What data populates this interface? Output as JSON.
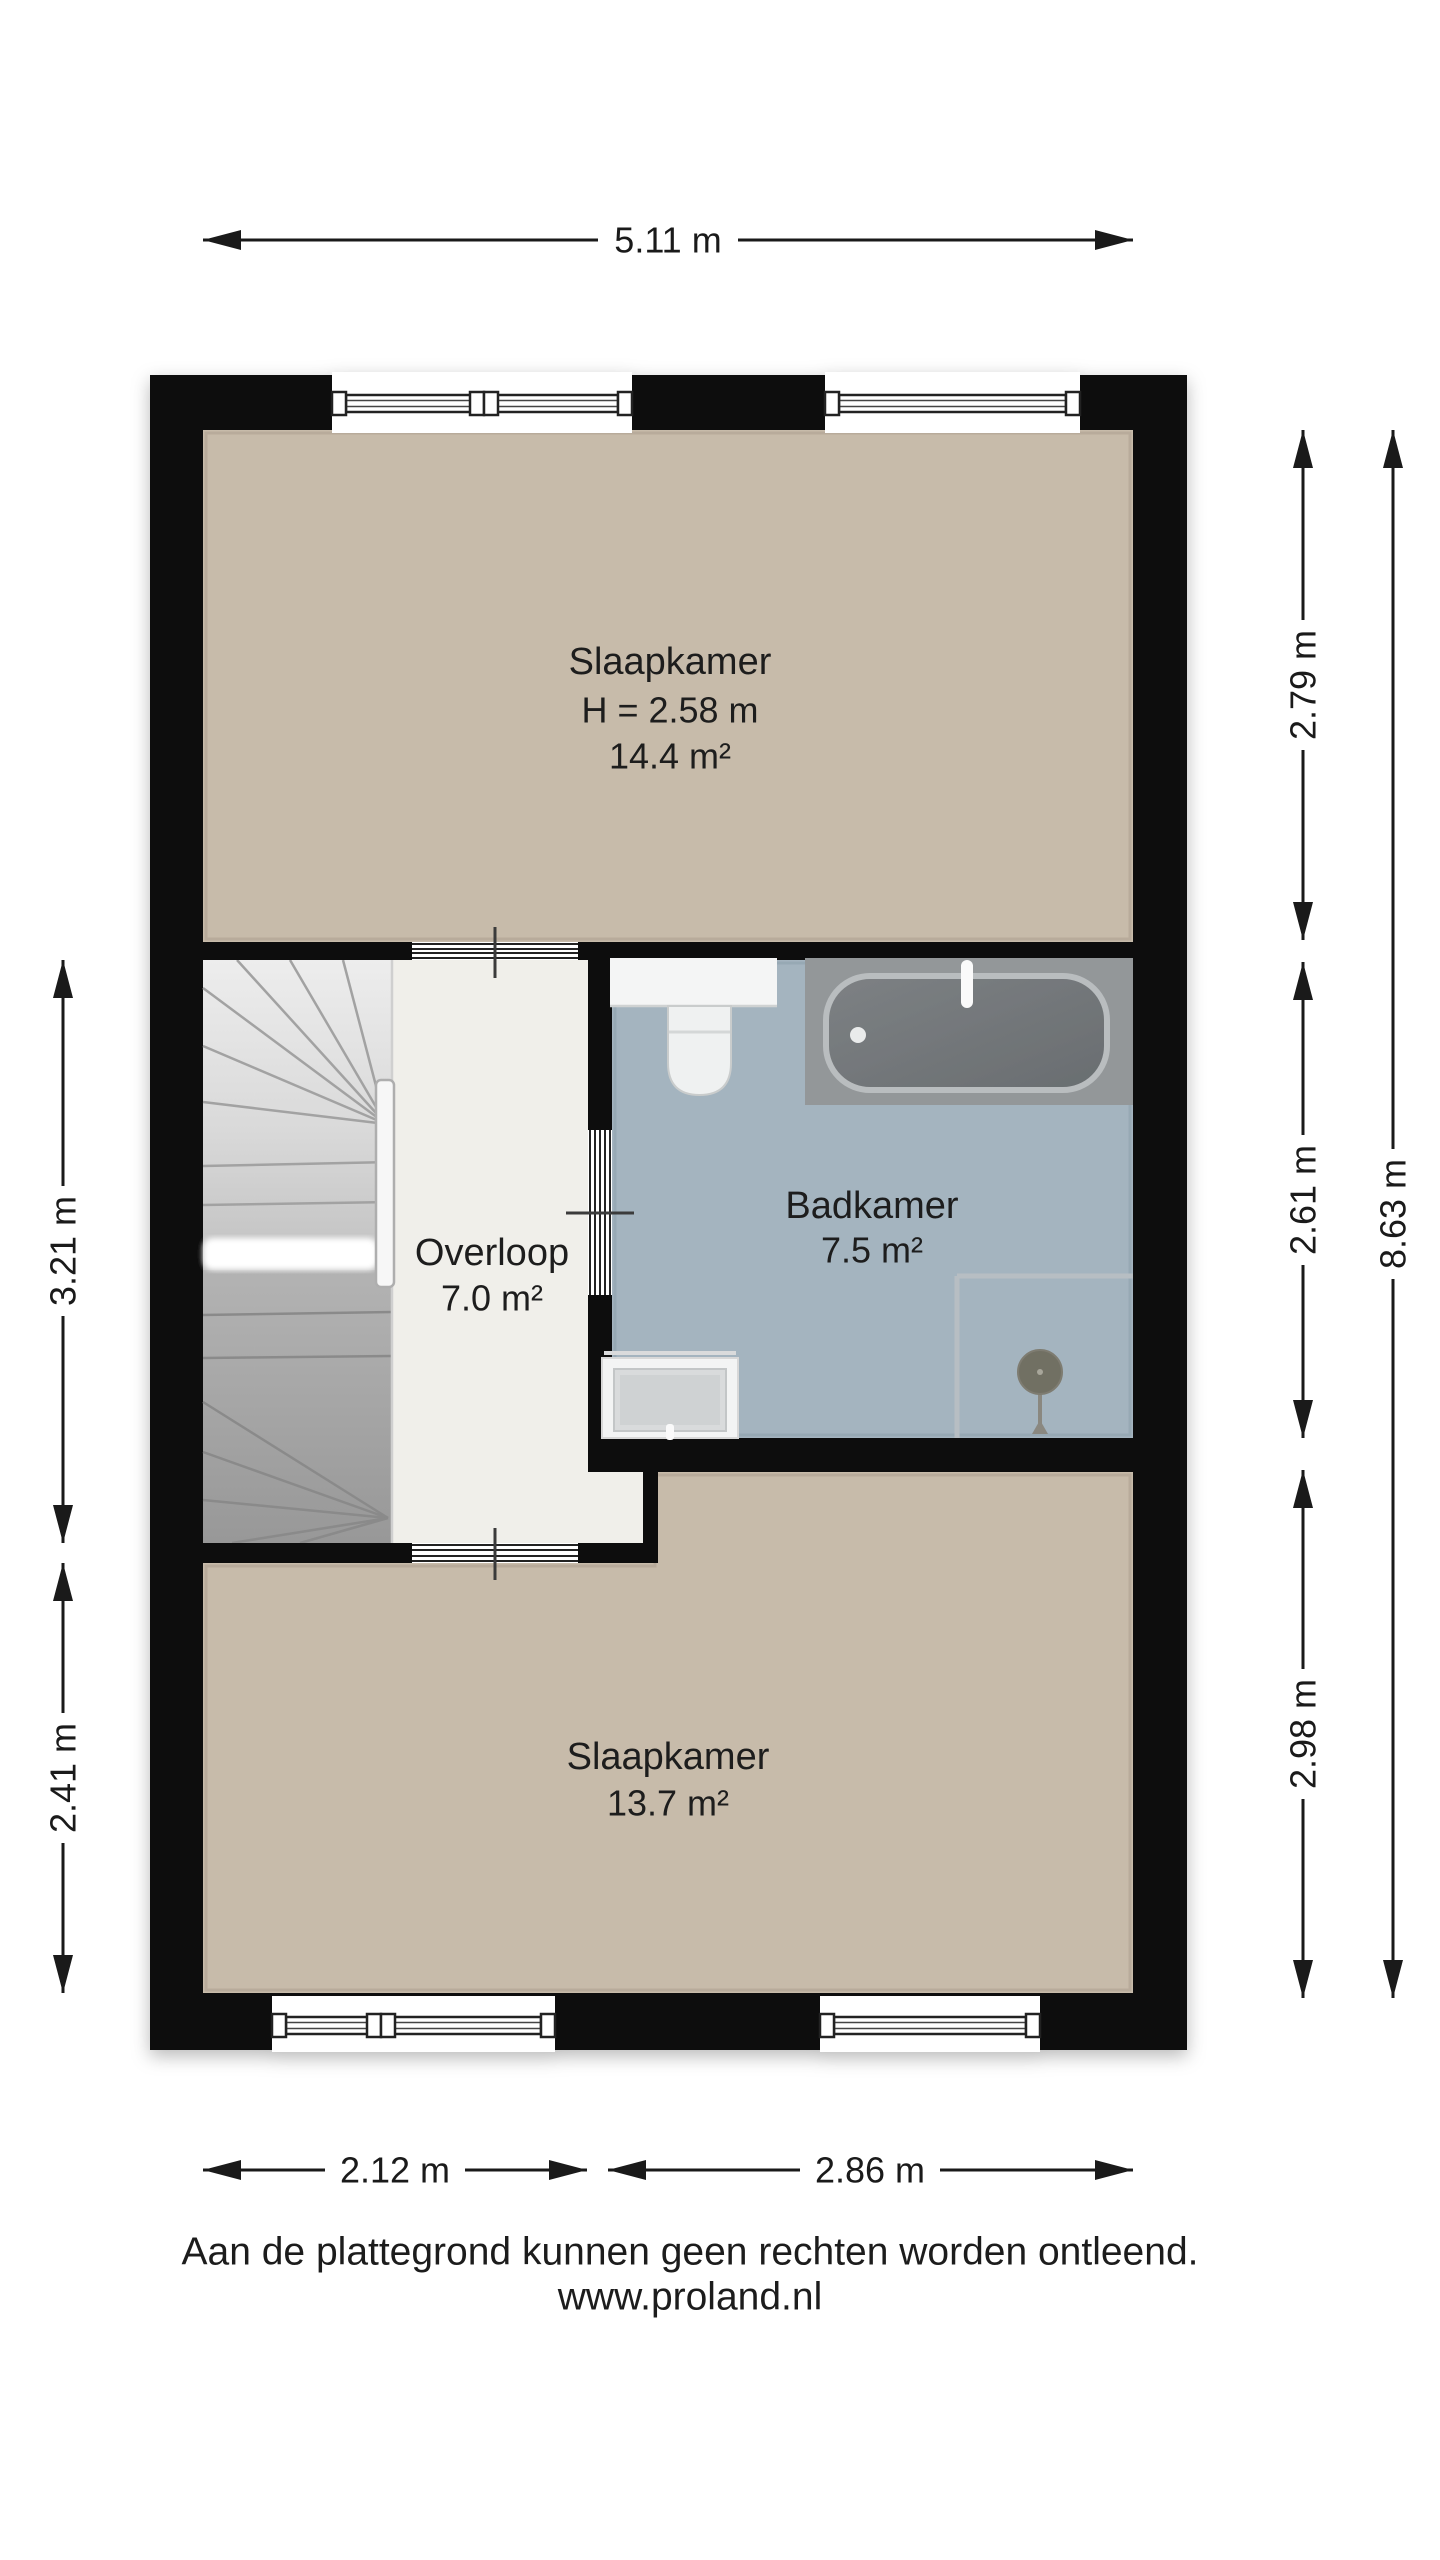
{
  "floorplan": {
    "rooms": [
      {
        "id": "slaapkamer-top",
        "label": "Slaapkamer",
        "height_label": "H = 2.58 m",
        "area_label": "14.4 m²"
      },
      {
        "id": "overloop",
        "label": "Overloop",
        "area_label": "7.0 m²"
      },
      {
        "id": "badkamer",
        "label": "Badkamer",
        "area_label": "7.5 m²"
      },
      {
        "id": "slaapkamer-bottom",
        "label": "Slaapkamer",
        "area_label": "13.7 m²"
      }
    ],
    "dimensions": {
      "top": "5.11 m",
      "bottom_left": "2.12 m",
      "bottom_right": "2.86 m",
      "left_upper": "3.21 m",
      "left_lower": "2.41 m",
      "right_upper": "2.79 m",
      "right_middle": "2.61 m",
      "right_lower": "2.98 m",
      "right_total": "8.63 m"
    },
    "fixtures": [
      "staircase",
      "railing",
      "bathtub",
      "toilet",
      "washbasin",
      "shower"
    ],
    "colors": {
      "wall": "#0b0b0b",
      "bedroom_floor": "#c7bbaa",
      "bathroom_floor": "#a4b4bf",
      "landing_floor": "#f0efea",
      "stair_light": "#e9e9e9",
      "stair_dark": "#9a9a9a",
      "dimension_text": "#1a1a1a"
    }
  },
  "footer": {
    "disclaimer": "Aan de plattegrond kunnen geen rechten worden ontleend.",
    "website": "www.proland.nl"
  }
}
